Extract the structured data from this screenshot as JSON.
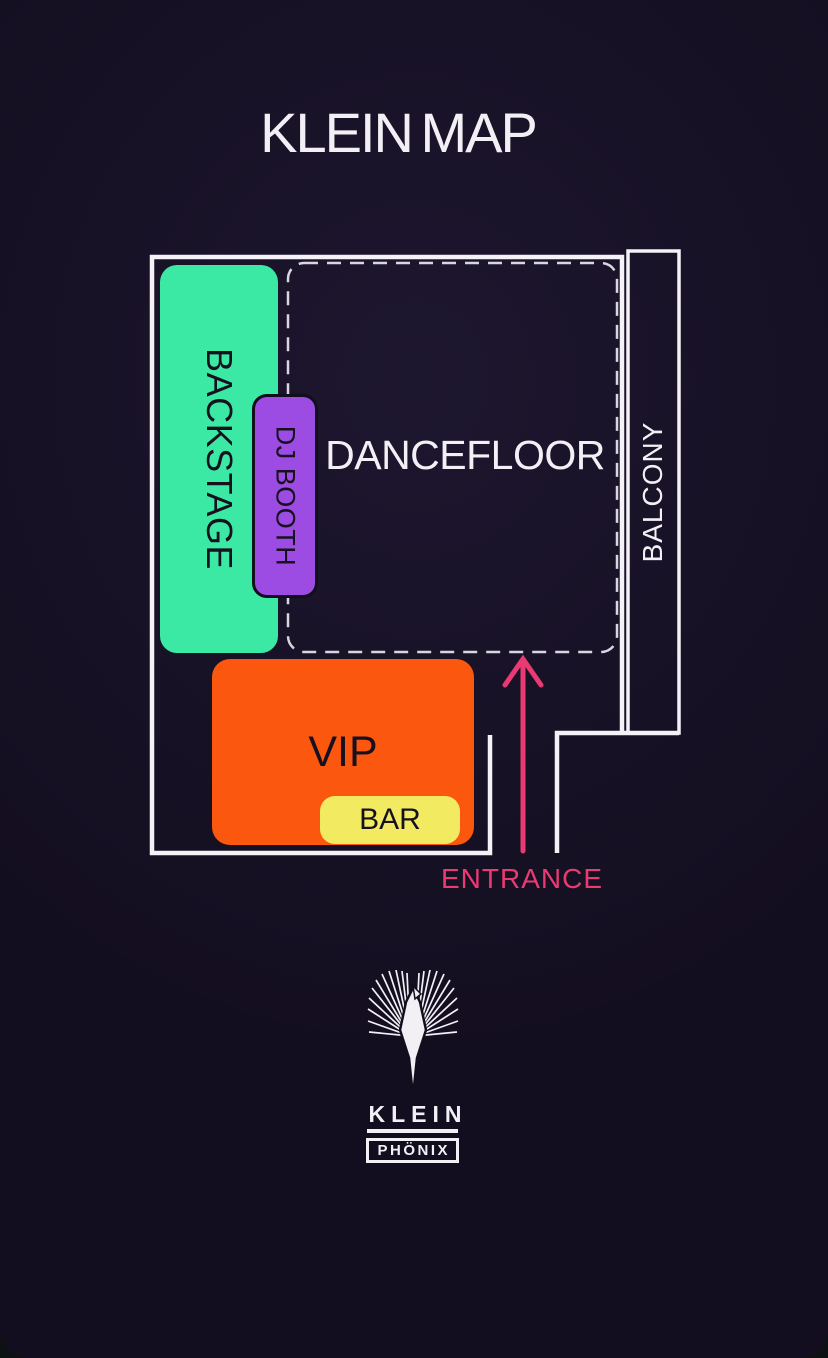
{
  "page": {
    "title": "KLEIN MAP",
    "title_color": "#F2F0F5",
    "background": "#130E1F"
  },
  "map": {
    "wall_color": "#F4F2F6",
    "dash_color": "#D8D6DE",
    "area_label_color": "#17111F",
    "areas": {
      "backstage": {
        "label": "BACKSTAGE",
        "color": "#3BE9A4"
      },
      "dj_booth": {
        "label": "DJ BOOTH",
        "color": "#9C4BE3"
      },
      "dancefloor": {
        "label": "DANCEFLOOR",
        "color": "#F2F0F5"
      },
      "balcony": {
        "label": "BALCONY",
        "color": "#F2F0F5"
      },
      "vip": {
        "label": "VIP",
        "color": "#FB570E"
      },
      "bar": {
        "label": "BAR",
        "color": "#F2EB62"
      },
      "entrance": {
        "label": "ENTRANCE",
        "color": "#E93A72"
      }
    }
  },
  "footer": {
    "brand_name": "KLEIN",
    "brand_sub": "PHÖNIX"
  }
}
